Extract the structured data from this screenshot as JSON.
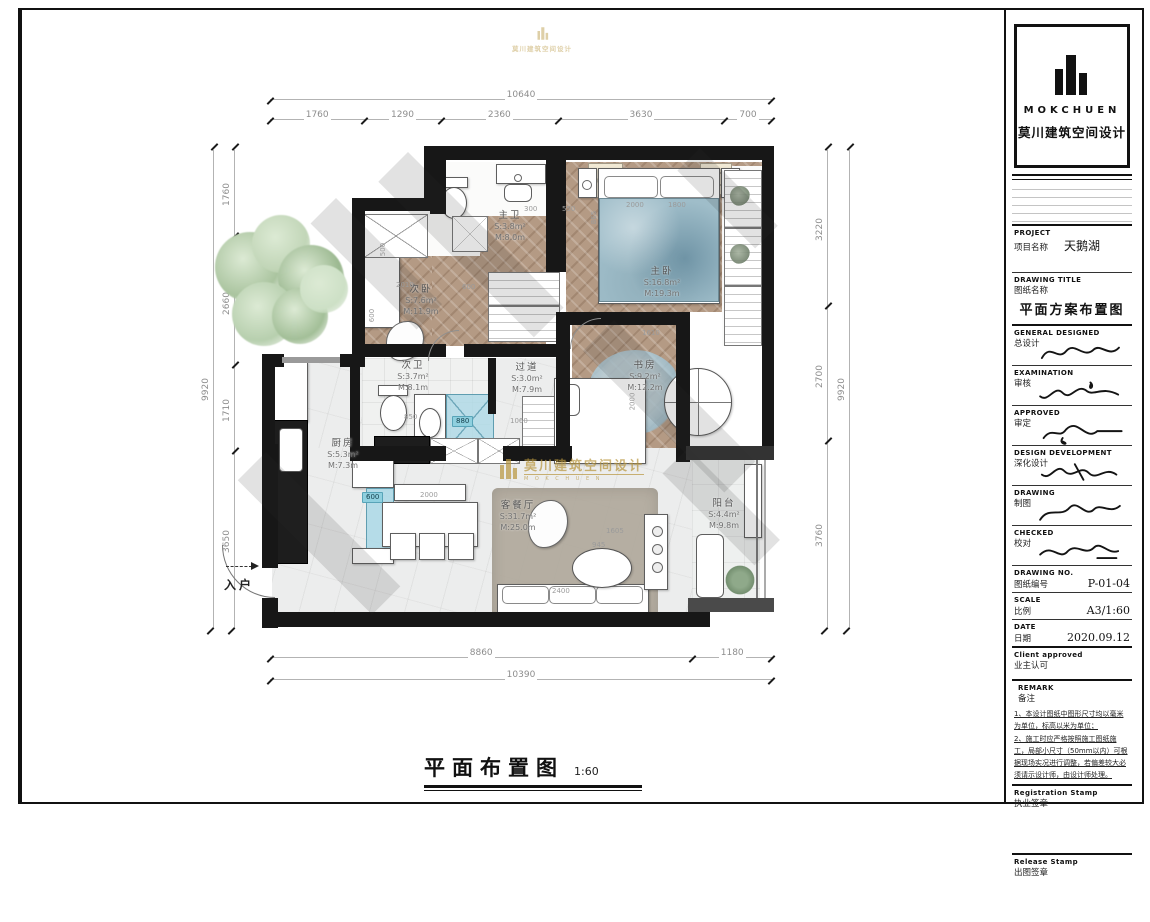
{
  "title_block": {
    "brand": "MOKCHUEN",
    "company": "莫川建筑空间设计",
    "fields": [
      {
        "en": "PROJECT",
        "zh": "项目名称",
        "value": "天鹅湖"
      },
      {
        "en": "DRAWING TITLE",
        "zh": "图纸名称",
        "value": "平面方案布置图"
      },
      {
        "en": "GENERAL  DESIGNED",
        "zh": "总设计",
        "value": ""
      },
      {
        "en": "EXAMINATION",
        "zh": "审核",
        "value": ""
      },
      {
        "en": "APPROVED",
        "zh": "审定",
        "value": ""
      },
      {
        "en": "DESIGN DEVELOPMENT",
        "zh": "深化设计",
        "value": ""
      },
      {
        "en": "DRAWING",
        "zh": "制图",
        "value": ""
      },
      {
        "en": "CHECKED",
        "zh": "校对",
        "value": ""
      },
      {
        "en": "DRAWING NO.",
        "zh": "图纸编号",
        "value": "P-01-04"
      },
      {
        "en": "SCALE",
        "zh": "比例",
        "value": "A3/1:60"
      },
      {
        "en": "DATE",
        "zh": "日期",
        "value": "2020.09.12"
      },
      {
        "en": "Client approved",
        "zh": "业主认可",
        "value": ""
      }
    ],
    "remark": {
      "en": "REMARK",
      "zh": "备注",
      "notes": [
        "1、本设计图纸中图形尺寸均以毫米为单位，标高以米为单位；",
        "2、施工时应严格按照施工图纸施工，局部小尺寸（50mm以内）可根据现场实况进行调整，若偏差较大必须请示设计师，由设计师处理。"
      ]
    },
    "stamps": [
      {
        "en": "Registration Stamp",
        "zh": "执业签章"
      },
      {
        "en": "Release Stamp",
        "zh": "出图签章"
      }
    ]
  },
  "plan": {
    "rooms": [
      {
        "name": "次卧",
        "area": "S:7.6m²",
        "meters": "M:11.9m"
      },
      {
        "name": "主卫",
        "area": "S:3.8m²",
        "meters": "M:8.0m"
      },
      {
        "name": "主卧",
        "area": "S:16.8m²",
        "meters": "M:19.3m"
      },
      {
        "name": "次卫",
        "area": "S:3.7m²",
        "meters": "M:8.1m"
      },
      {
        "name": "过道",
        "area": "S:3.0m²",
        "meters": "M:7.9m"
      },
      {
        "name": "书房",
        "area": "S:9.2m²",
        "meters": "M:12.2m"
      },
      {
        "name": "厨房",
        "area": "S:5.3m²",
        "meters": "M:7.3m"
      },
      {
        "name": "客餐厅",
        "area": "S:31.7m²",
        "meters": "M:25.0m"
      },
      {
        "name": "阳台",
        "area": "S:4.4m²",
        "meters": "M:9.8m"
      }
    ],
    "entrance_label": "入户",
    "dimensions": {
      "top": {
        "total": "10640",
        "segments": [
          "1760",
          "1290",
          "2360",
          "3630",
          "700"
        ]
      },
      "bottom": {
        "total": "10390",
        "segments": [
          "8860",
          "1180"
        ]
      },
      "left": {
        "total": "9920",
        "segments": [
          "1760",
          "2660",
          "1710",
          "3650"
        ]
      },
      "right": {
        "total": "9920",
        "segments": [
          "3220",
          "2700",
          "3760"
        ]
      }
    },
    "inner_dims": [
      "2010",
      "600",
      "500",
      "600",
      "2000",
      "1800",
      "1610",
      "300",
      "550",
      "865",
      "850",
      "880",
      "1060",
      "2000",
      "600",
      "2000",
      "2400",
      "945",
      "1605"
    ],
    "highlight_color": "#8fd0df"
  },
  "watermark": {
    "text": "莫川建筑空间设计",
    "subtext": "M O K C H U E N",
    "color": "#b8963e"
  },
  "footer": {
    "title": "平面布置图",
    "scale": "1:60"
  }
}
